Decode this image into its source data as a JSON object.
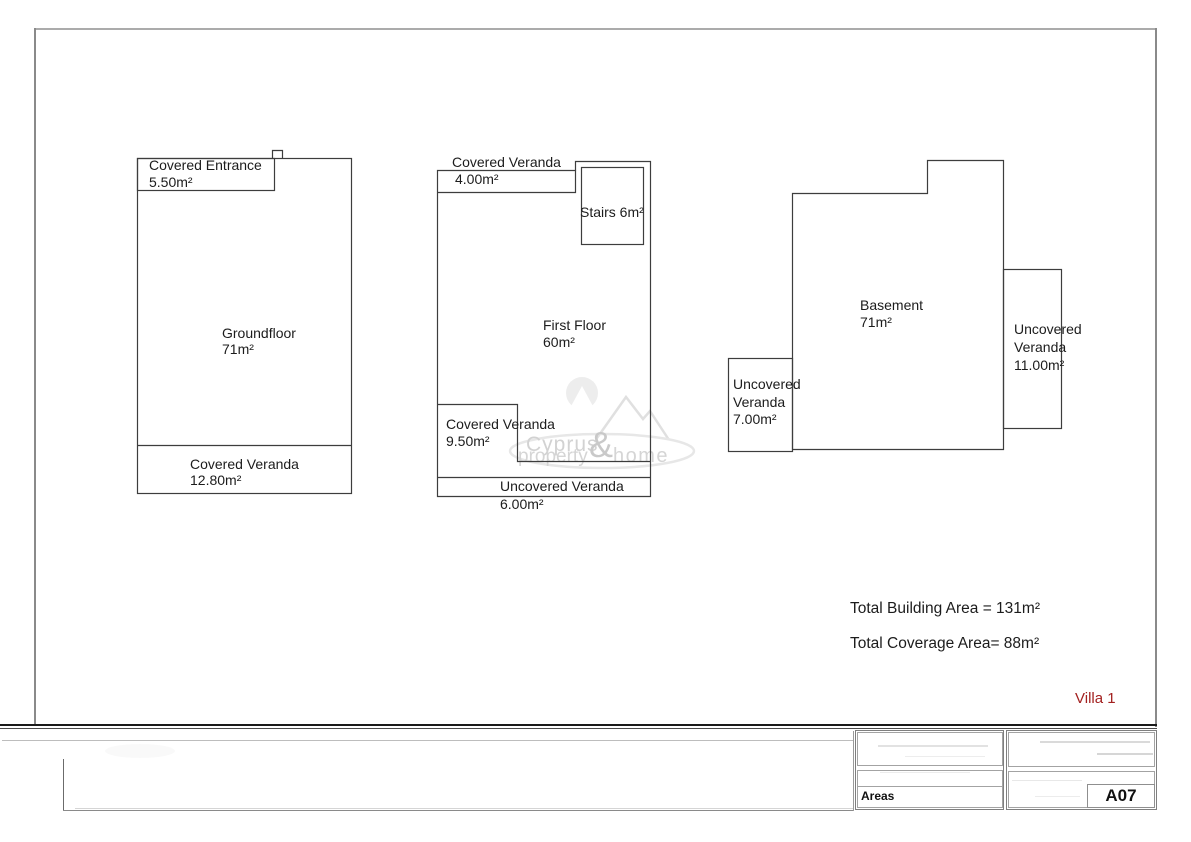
{
  "drawing": {
    "villa_label": "Villa 1",
    "totals": {
      "building_area": "Total Building Area = 131m²",
      "coverage_area": "Total Coverage Area= 88m²"
    },
    "groundfloor": {
      "entrance_line1": "Covered Entrance",
      "entrance_line2": "5.50m²",
      "label_line1": "Groundfloor",
      "label_line2": "71m²",
      "veranda_line1": "Covered Veranda",
      "veranda_line2": "12.80m²"
    },
    "first_floor": {
      "top_veranda_label": "Covered Veranda",
      "top_veranda_area": "4.00m²",
      "stairs_label": "Stairs 6m²",
      "label_line1": "First Floor",
      "label_line2": "60m²",
      "bottom_veranda_line1": "Covered Veranda",
      "bottom_veranda_line2": "9.50m²",
      "uncovered_line1": "Uncovered Veranda",
      "uncovered_line2": "6.00m²"
    },
    "basement": {
      "label_line1": "Basement",
      "label_line2": "71m²",
      "left_veranda_line1": "Uncovered",
      "left_veranda_line2": "Veranda",
      "left_veranda_line3": "7.00m²",
      "right_veranda_line1": "Uncovered",
      "right_veranda_line2": "Veranda",
      "right_veranda_line3": "11.00m²"
    }
  },
  "watermark": {
    "line1": "Cyprus",
    "amp": "&",
    "line2_left": "property",
    "line2_right": "home"
  },
  "title_block": {
    "areas_label": "Areas",
    "sheet_number": "A07"
  },
  "colors": {
    "plan_line": "#3d3d3d",
    "villa_red": "#a32120",
    "watermark_gray": "#d2d2d2"
  }
}
